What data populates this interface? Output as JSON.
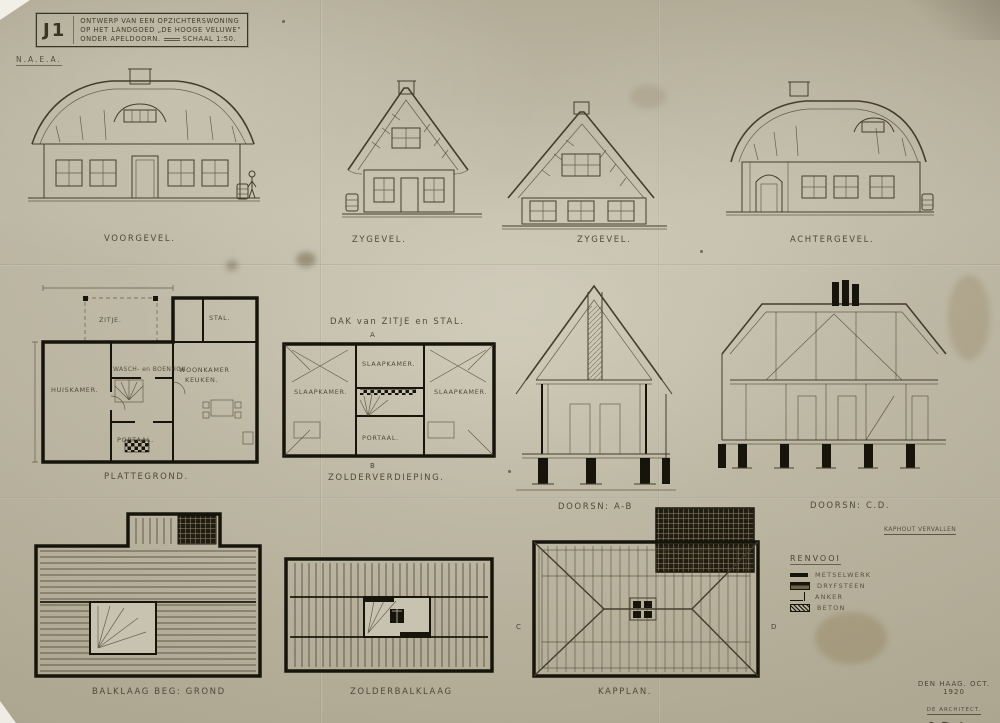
{
  "title_block": {
    "code": "J1",
    "line1": "ONTWERP VAN EEN OPZICHTERSWONING",
    "line2": "OP HET LANDGOED „DE HOOGE VELUWE”",
    "line3": "ONDER APELDOORN.",
    "scale": "SCHAAL 1:50."
  },
  "stamp": "N.A.E.A.",
  "elevations": {
    "voorgevel": "VOORGEVEL.",
    "zygevel1": "ZYGEVEL.",
    "zygevel2": "ZYGEVEL.",
    "achtergevel": "ACHTERGEVEL."
  },
  "plattegrond": {
    "label": "PLATTEGROND.",
    "rooms": {
      "zitje": "ZITJE.",
      "stal": "STAL.",
      "huiskamer": "HUISKAMER.",
      "waschhok": "WASCH- en BOENHOK",
      "woonkamer": "WOONKAMER",
      "keuken": "KEUKEN.",
      "portaal": "PORTAAL."
    }
  },
  "zolderverdieping": {
    "label": "ZOLDERVERDIEPING.",
    "header": "DAK van ZITJE en STAL.",
    "rooms": {
      "slaapkamer1": "SLAAPKAMER.",
      "slaapkamer2": "SLAAPKAMER.",
      "slaapkamer3": "SLAAPKAMER.",
      "portaal": "PORTAAL."
    }
  },
  "sections": {
    "ab": "DOORSN: A-B",
    "cd": "DOORSN: C.D.",
    "note": "KAPHOUT VERVALLEN"
  },
  "legend": {
    "title": "RENVOOI",
    "items": [
      {
        "label": "METSELWERK"
      },
      {
        "label": "DRYFSTEEN"
      },
      {
        "label": "ANKER"
      },
      {
        "label": "BETON"
      }
    ]
  },
  "bottom_row": {
    "balklaag": "BALKLAAG BEG: GROND",
    "zolderbalklaag": "ZOLDERBALKLAAG",
    "kapplan": "KAPPLAN."
  },
  "signature_block": {
    "line1": "DEN HAAG. OCT. 1920",
    "line2": "DE ARCHITECT."
  },
  "markers": {
    "a": "A",
    "b": "B",
    "c": "C",
    "d": "D"
  },
  "colors": {
    "paper": "#c8c3b0",
    "ink": "#443d2c",
    "black": "#17140c"
  }
}
